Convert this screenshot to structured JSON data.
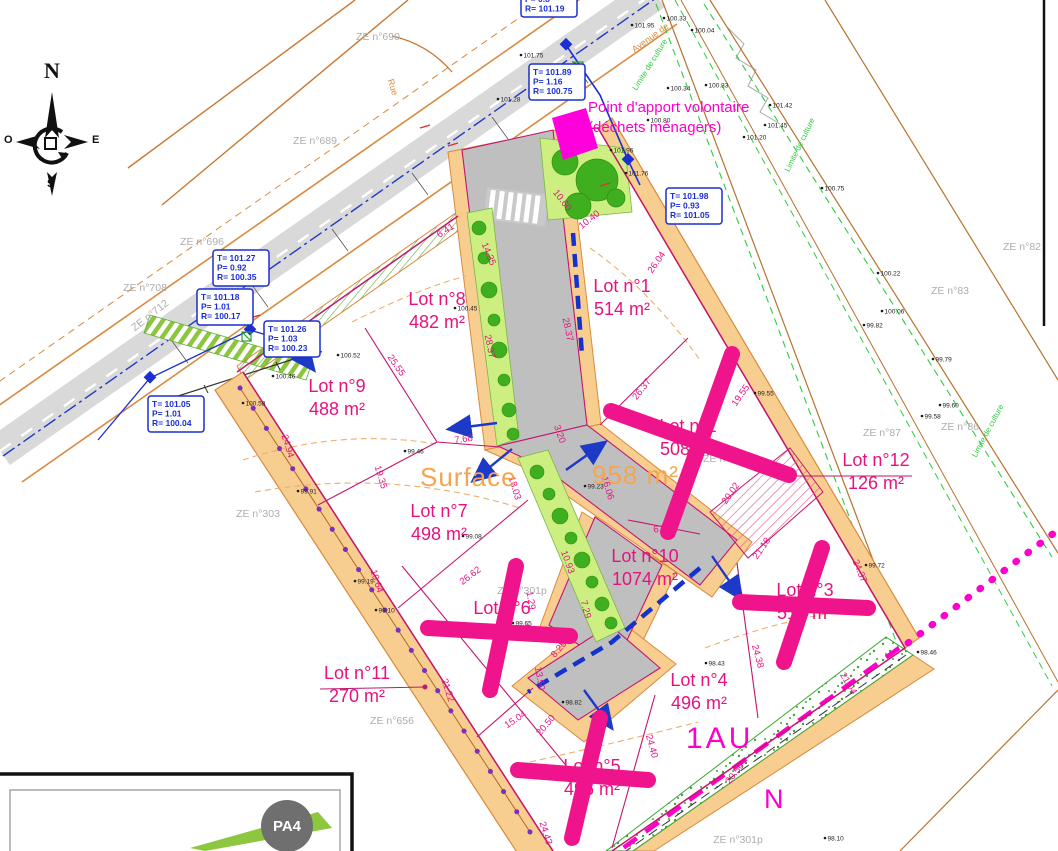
{
  "annotations": {
    "point_apport_line1": "Point d'apport volontaire",
    "point_apport_line2": "(déchets ménagers)",
    "surface_label": "Surface",
    "surface_value": "958 m²",
    "zone_label": "1AU",
    "north_label": "N",
    "sheet_badge": "PA4"
  },
  "compass": {
    "n": "N",
    "s": "S",
    "e": "E",
    "o": "O"
  },
  "colors": {
    "lot_label": "#E6127F",
    "sold_cross": "#F0148C",
    "zone_magenta": "#FF00CC",
    "surface_orange": "#F5A54F",
    "road_orange": "#D98A3D",
    "road_tan": "#F7CE8F",
    "road_gray": "#BFBFBF",
    "survey_blue": "#1B2FD0",
    "field_brown": "#B5732F",
    "culture_green": "#2ECC40",
    "parcel_gray": "#ADADAD"
  },
  "lots": [
    {
      "name": "Lot n°1",
      "area": "514 m²",
      "x": 622,
      "y": 292,
      "crossed": false
    },
    {
      "name": "Lot n°2",
      "area": "508 m²",
      "x": 688,
      "y": 432,
      "crossed": true
    },
    {
      "name": "Lot n°3",
      "area": "510 m²",
      "x": 805,
      "y": 596,
      "crossed": true
    },
    {
      "name": "Lot n°4",
      "area": "496 m²",
      "x": 699,
      "y": 686,
      "crossed": false
    },
    {
      "name": "Lot n°5",
      "area": "496 m²",
      "x": 592,
      "y": 772,
      "crossed": true
    },
    {
      "name": "Lot n°6",
      "area": "492 m²",
      "x": 502,
      "y": 614,
      "crossed": true
    },
    {
      "name": "Lot n°7",
      "area": "498 m²",
      "x": 439,
      "y": 517,
      "crossed": false
    },
    {
      "name": "Lot n°8",
      "area": "482 m²",
      "x": 437,
      "y": 305,
      "crossed": false
    },
    {
      "name": "Lot n°9",
      "area": "488 m²",
      "x": 337,
      "y": 392,
      "crossed": false
    },
    {
      "name": "Lot n°10",
      "area": "1074 m²",
      "x": 645,
      "y": 562,
      "crossed": false
    },
    {
      "name": "Lot n°11",
      "area": "270 m²",
      "x": 357,
      "y": 679,
      "crossed": false
    },
    {
      "name": "Lot n°12",
      "area": "126 m²",
      "x": 876,
      "y": 466,
      "crossed": false
    }
  ],
  "dimensions": [
    {
      "v": "10.60",
      "x": 560,
      "y": 202,
      "r": 52
    },
    {
      "v": "6.41",
      "x": 447,
      "y": 233,
      "r": -33
    },
    {
      "v": "14.35",
      "x": 486,
      "y": 255,
      "r": 68
    },
    {
      "v": "28.37",
      "x": 487,
      "y": 347,
      "r": 78
    },
    {
      "v": "28.37",
      "x": 565,
      "y": 330,
      "r": 78
    },
    {
      "v": "10.40",
      "x": 591,
      "y": 222,
      "r": -38
    },
    {
      "v": "26.04",
      "x": 659,
      "y": 264,
      "r": -55
    },
    {
      "v": "26.37",
      "x": 644,
      "y": 391,
      "r": -52
    },
    {
      "v": "19.55",
      "x": 743,
      "y": 397,
      "r": -55
    },
    {
      "v": "20.02",
      "x": 733,
      "y": 495,
      "r": -55
    },
    {
      "v": "6.85",
      "x": 663,
      "y": 531,
      "r": -12
    },
    {
      "v": "21.18",
      "x": 764,
      "y": 550,
      "r": -55
    },
    {
      "v": "24.37",
      "x": 857,
      "y": 572,
      "r": 68
    },
    {
      "v": "24.38",
      "x": 755,
      "y": 657,
      "r": 75
    },
    {
      "v": "21.04",
      "x": 846,
      "y": 685,
      "r": 58
    },
    {
      "v": "24.40",
      "x": 649,
      "y": 747,
      "r": 75
    },
    {
      "v": "20.50",
      "x": 737,
      "y": 775,
      "r": -52
    },
    {
      "v": "24.43",
      "x": 543,
      "y": 834,
      "r": 72
    },
    {
      "v": "20.50",
      "x": 548,
      "y": 727,
      "r": -50
    },
    {
      "v": "15.04",
      "x": 517,
      "y": 722,
      "r": -33
    },
    {
      "v": "21.22",
      "x": 445,
      "y": 691,
      "r": 72
    },
    {
      "v": "19.64",
      "x": 374,
      "y": 582,
      "r": 72
    },
    {
      "v": "26.62",
      "x": 472,
      "y": 578,
      "r": -37
    },
    {
      "v": "7.29",
      "x": 583,
      "y": 610,
      "r": 75
    },
    {
      "v": "8.25",
      "x": 561,
      "y": 651,
      "r": -50
    },
    {
      "v": "13.50",
      "x": 537,
      "y": 679,
      "r": 80
    },
    {
      "v": "1.29",
      "x": 528,
      "y": 601,
      "r": 80
    },
    {
      "v": "10.93",
      "x": 565,
      "y": 563,
      "r": 70
    },
    {
      "v": "18.03",
      "x": 512,
      "y": 489,
      "r": 73
    },
    {
      "v": "16.06",
      "x": 605,
      "y": 489,
      "r": 73
    },
    {
      "v": "3.20",
      "x": 557,
      "y": 435,
      "r": 70
    },
    {
      "v": "25.55",
      "x": 394,
      "y": 367,
      "r": 55
    },
    {
      "v": "24.94",
      "x": 285,
      "y": 447,
      "r": 73
    },
    {
      "v": "19.35",
      "x": 378,
      "y": 478,
      "r": 73
    },
    {
      "v": "7.68",
      "x": 464,
      "y": 442,
      "r": -8
    }
  ],
  "parcels": [
    {
      "t": "ZE n°690",
      "x": 378,
      "y": 40,
      "r": 0
    },
    {
      "t": "ZE n°689",
      "x": 315,
      "y": 144,
      "r": 0
    },
    {
      "t": "ZE n°696",
      "x": 202,
      "y": 245,
      "r": 0
    },
    {
      "t": "ZE n°708",
      "x": 145,
      "y": 291,
      "r": 0
    },
    {
      "t": "ZE n°712",
      "x": 152,
      "y": 318,
      "r": -38
    },
    {
      "t": "ZE n°303",
      "x": 258,
      "y": 517,
      "r": 0
    },
    {
      "t": "ZE n°656",
      "x": 392,
      "y": 724,
      "r": 0
    },
    {
      "t": "ZE n°300p",
      "x": 728,
      "y": 462,
      "r": 0
    },
    {
      "t": "ZE n°301p",
      "x": 522,
      "y": 594,
      "r": 0
    },
    {
      "t": "ZE n°301p",
      "x": 738,
      "y": 843,
      "r": 0
    },
    {
      "t": "ZE n°83",
      "x": 950,
      "y": 294,
      "r": 0
    },
    {
      "t": "ZE n°86",
      "x": 960,
      "y": 430,
      "r": 0
    },
    {
      "t": "ZE n°87",
      "x": 882,
      "y": 436,
      "r": 0
    },
    {
      "t": "ZE n°82",
      "x": 1022,
      "y": 250,
      "r": 0
    }
  ],
  "road_names": [
    {
      "t": "Avenue de",
      "x": 652,
      "y": 40,
      "r": -36,
      "cls": "roadname"
    },
    {
      "t": "Rue",
      "x": 390,
      "y": 88,
      "r": 72,
      "cls": "roadname"
    },
    {
      "t": "Limite de culture",
      "x": 652,
      "y": 66,
      "r": -58,
      "cls": "culture"
    },
    {
      "t": "Limite de culture",
      "x": 802,
      "y": 146,
      "r": -64,
      "cls": "culture"
    },
    {
      "t": "Limite de culture",
      "x": 990,
      "y": 432,
      "r": -62,
      "cls": "culture"
    }
  ],
  "manholes": [
    {
      "x": 521,
      "y": -9,
      "lines": [
        "P= 0.8",
        "R= 101.19"
      ]
    },
    {
      "x": 529,
      "y": 64,
      "lines": [
        "T= 101.89",
        "P= 1.16",
        "R= 100.75"
      ]
    },
    {
      "x": 666,
      "y": 188,
      "lines": [
        "T= 101.98",
        "P= 0.93",
        "R= 101.05"
      ]
    },
    {
      "x": 213,
      "y": 250,
      "lines": [
        "T= 101.27",
        "P= 0.92",
        "R= 100.35"
      ]
    },
    {
      "x": 197,
      "y": 289,
      "lines": [
        "T= 101.18",
        "P= 1.01",
        "R= 100.17"
      ]
    },
    {
      "x": 264,
      "y": 321,
      "lines": [
        "T= 101.26",
        "P= 1.03",
        "R= 100.23"
      ]
    },
    {
      "x": 148,
      "y": 396,
      "lines": [
        "T= 101.05",
        "P= 1.01",
        "R= 100.04"
      ]
    }
  ],
  "spot_levels": [
    {
      "v": "101.75",
      "x": 521,
      "y": 55
    },
    {
      "v": "101.28",
      "x": 498,
      "y": 99
    },
    {
      "v": "101.95",
      "x": 632,
      "y": 25
    },
    {
      "v": "100.33",
      "x": 664,
      "y": 18
    },
    {
      "v": "100.04",
      "x": 692,
      "y": 30
    },
    {
      "v": "100.34",
      "x": 668,
      "y": 88
    },
    {
      "v": "100.33",
      "x": 706,
      "y": 85
    },
    {
      "v": "100.80",
      "x": 648,
      "y": 120
    },
    {
      "v": "101.96",
      "x": 611,
      "y": 150
    },
    {
      "v": "101.76",
      "x": 626,
      "y": 173
    },
    {
      "v": "101.42",
      "x": 770,
      "y": 105
    },
    {
      "v": "101.45",
      "x": 765,
      "y": 125
    },
    {
      "v": "101.20",
      "x": 744,
      "y": 137
    },
    {
      "v": "100.75",
      "x": 822,
      "y": 188
    },
    {
      "v": "100.22",
      "x": 878,
      "y": 273
    },
    {
      "v": "100.06",
      "x": 882,
      "y": 311
    },
    {
      "v": "99.82",
      "x": 864,
      "y": 325
    },
    {
      "v": "99.79",
      "x": 933,
      "y": 359
    },
    {
      "v": "99.60",
      "x": 940,
      "y": 405
    },
    {
      "v": "99.58",
      "x": 922,
      "y": 416
    },
    {
      "v": "100.45",
      "x": 455,
      "y": 308
    },
    {
      "v": "100.52",
      "x": 338,
      "y": 355
    },
    {
      "v": "100.46",
      "x": 273,
      "y": 376
    },
    {
      "v": "100.58",
      "x": 243,
      "y": 403
    },
    {
      "v": "99.91",
      "x": 298,
      "y": 491
    },
    {
      "v": "99.46",
      "x": 405,
      "y": 451
    },
    {
      "v": "99.23",
      "x": 585,
      "y": 486
    },
    {
      "v": "99.08",
      "x": 463,
      "y": 536
    },
    {
      "v": "99.19",
      "x": 355,
      "y": 581
    },
    {
      "v": "99.65",
      "x": 513,
      "y": 623
    },
    {
      "v": "99.10",
      "x": 376,
      "y": 610
    },
    {
      "v": "98.43",
      "x": 706,
      "y": 663
    },
    {
      "v": "98.10",
      "x": 825,
      "y": 838
    },
    {
      "v": "99.72",
      "x": 866,
      "y": 565
    },
    {
      "v": "98.46",
      "x": 918,
      "y": 652
    },
    {
      "v": "98.82",
      "x": 563,
      "y": 702
    },
    {
      "v": "99.55",
      "x": 755,
      "y": 393
    }
  ]
}
